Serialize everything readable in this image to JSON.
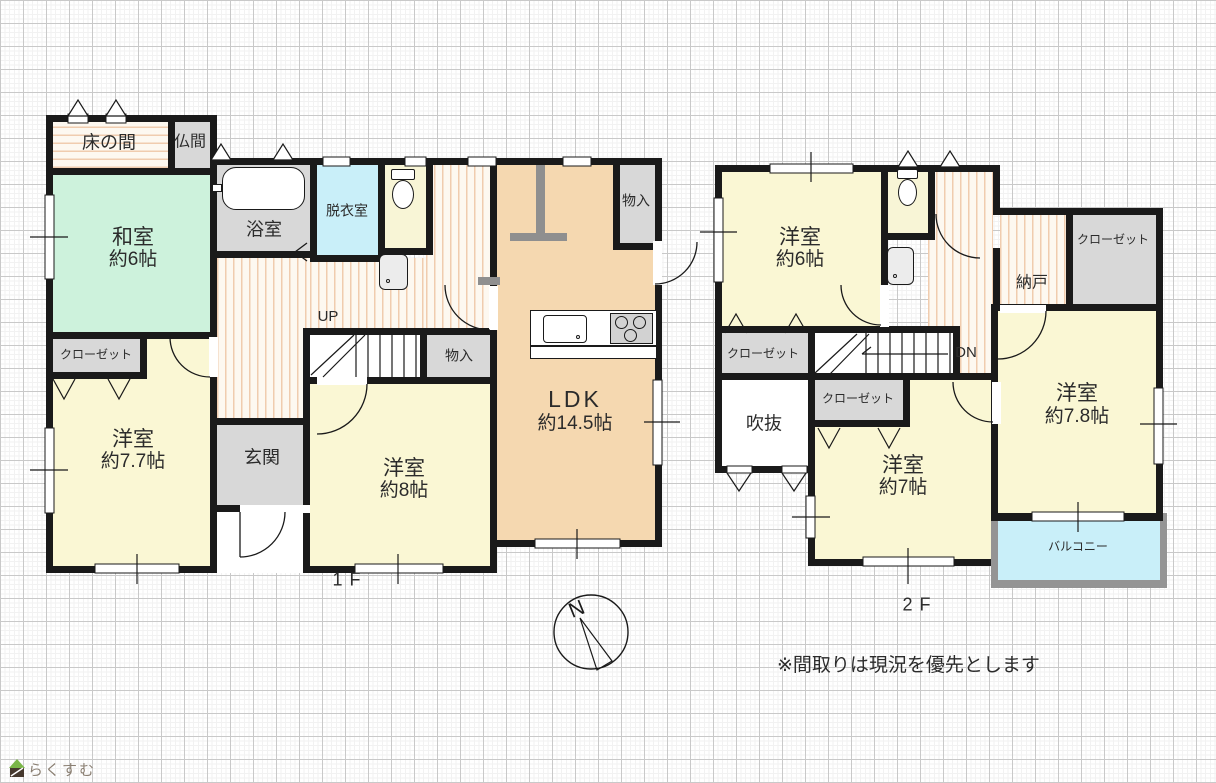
{
  "meta": {
    "type": "floorplan",
    "colors": {
      "wall": "#1a1a1a",
      "tatami_green": "#cdf2dc",
      "room_yellow": "#faf7d4",
      "ldk_orange": "#f5d8b0",
      "wet_area_cyan": "#c9eff9",
      "closet_gray": "#d8d8d8",
      "balcony_frame_gray": "#949494"
    }
  },
  "f1": {
    "floor_label": "1F",
    "tokonoma": "床の間",
    "butsuma": "仏間",
    "washitsu": {
      "name": "和室",
      "size": "約6帖"
    },
    "bathroom": "浴室",
    "dressing_room": "脱衣室",
    "closet": "クローゼット",
    "yoshitsu77": {
      "name": "洋室",
      "size": "約7.7帖"
    },
    "genkan": "玄関",
    "stairs_up": "UP",
    "storage_stairs": "物入",
    "storage_ldk": "物入",
    "yoshitsu8": {
      "name": "洋室",
      "size": "約8帖"
    },
    "ldk": {
      "name": "LDK",
      "size": "約14.5帖"
    }
  },
  "f2": {
    "floor_label": "2F",
    "yoshitsu6": {
      "name": "洋室",
      "size": "約6帖"
    },
    "nando": "納戸",
    "closet_right": "クローゼット",
    "closet_left": "クローゼット",
    "closet_mid": "クローゼット",
    "yoshitsu78": {
      "name": "洋室",
      "size": "約7.8帖"
    },
    "yoshitsu7": {
      "name": "洋室",
      "size": "約7帖"
    },
    "fukinuke": "吹抜",
    "balcony": "バルコニー",
    "stairs_down": "DN"
  },
  "compass": {
    "north": "N"
  },
  "note": "※間取りは現況を優先とします",
  "logo": "らくすむ"
}
